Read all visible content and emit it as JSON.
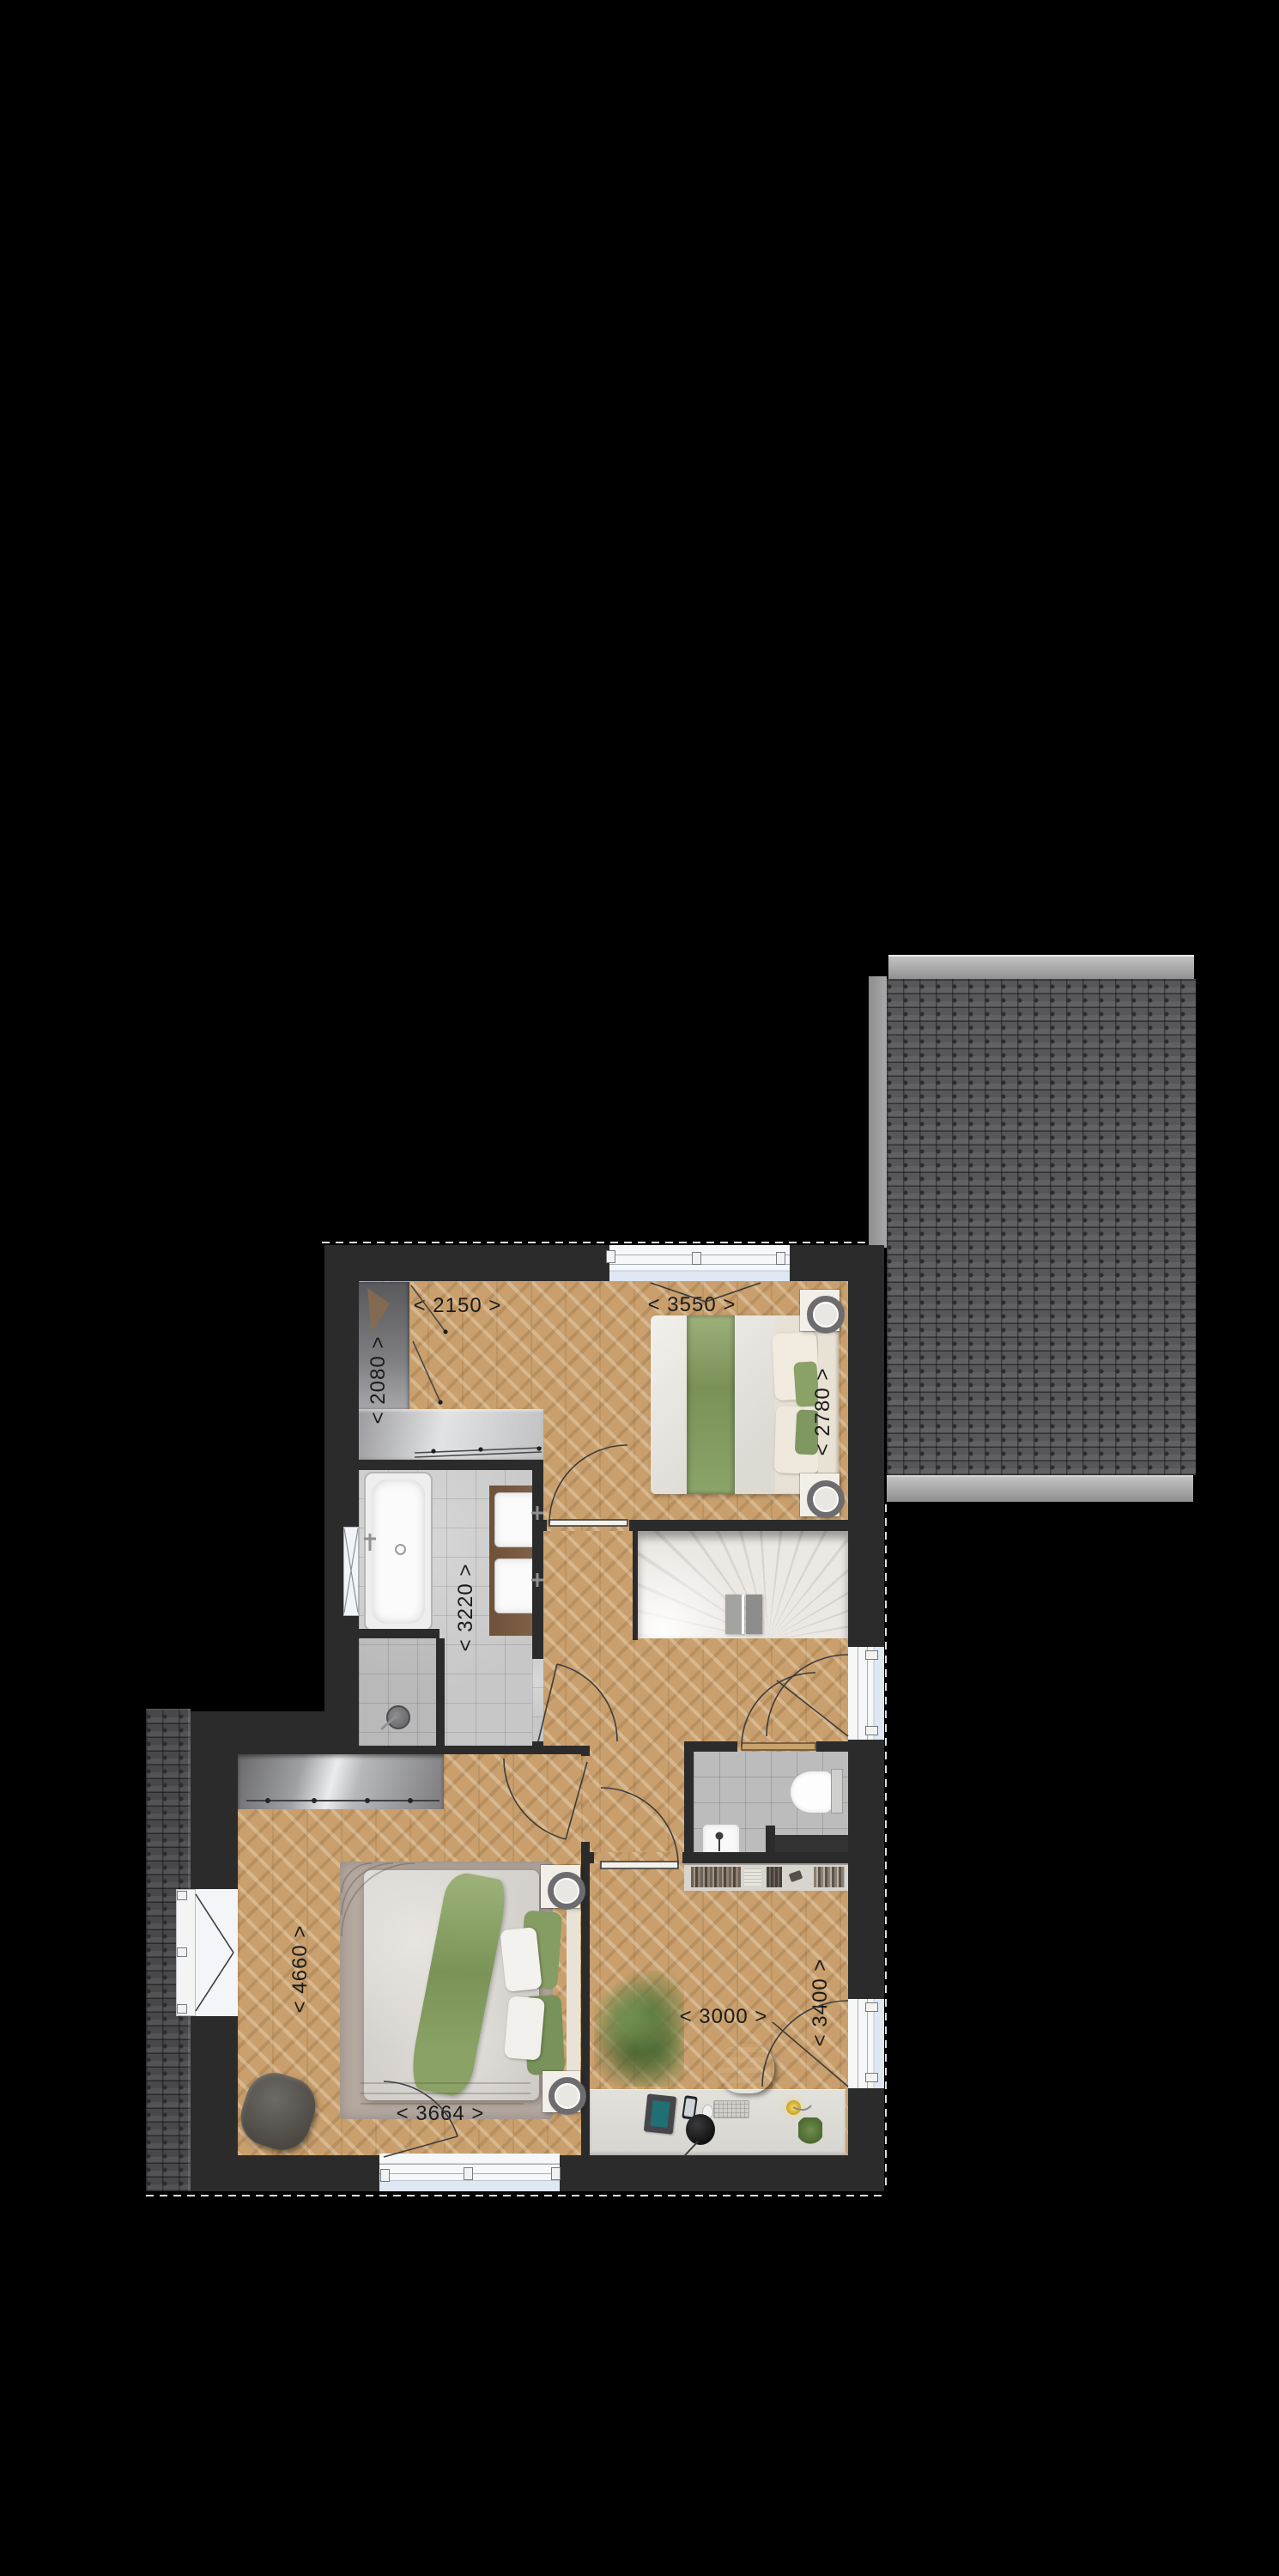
{
  "plan": {
    "type": "first-floor plan with roof sections",
    "dimensions": {
      "dressing_width": "< 2150 >",
      "dressing_depth": "< 2080 >",
      "bedroom_right_width": "< 3550 >",
      "bedroom_right_depth": "< 2780 >",
      "bathroom_depth": "< 3220 >",
      "bedroom_left_depth": "< 4660 >",
      "bedroom_left_width": "< 3664 >",
      "study_width": "< 3000 >",
      "study_depth": "< 3400 >"
    },
    "colors": {
      "background": "#000000",
      "wall": "#2b2b2c",
      "wood_floor": "#c9a06d",
      "bathroom_tile": "#c7c7c7",
      "toilet_tile": "#bcbcbc",
      "roof_tile": "#57575a",
      "roof_ridge": "#a9a9a9",
      "stairs": "#e6e4e0",
      "window_glass": "#dfe7f2",
      "accent_green": "#859c63",
      "counter_wood": "#7b5d43",
      "label_text": "#1b1b1b"
    }
  }
}
